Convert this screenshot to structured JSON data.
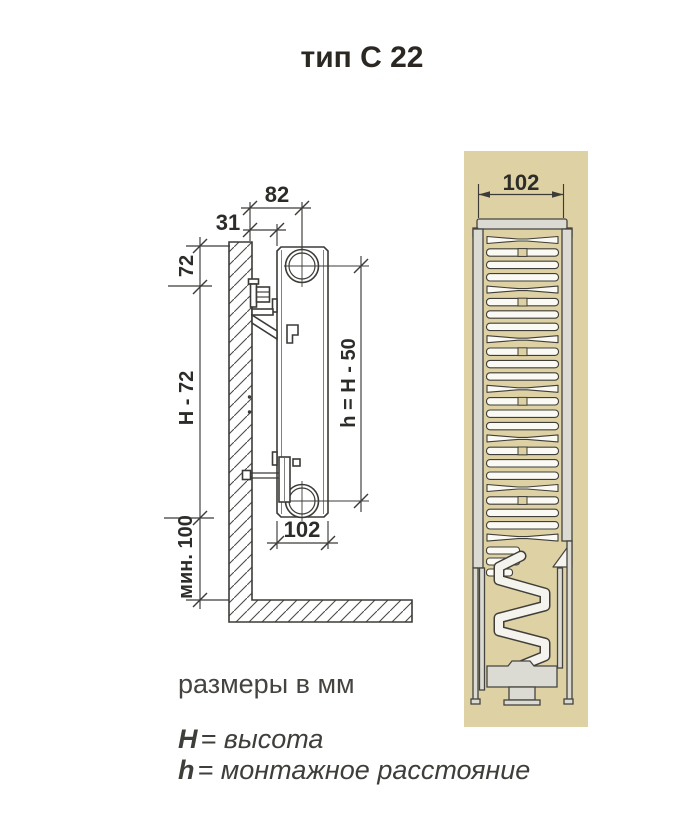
{
  "title": "тип С 22",
  "side_view": {
    "dims": {
      "top_offset": "82",
      "wall_gap": "31",
      "top_margin": "72",
      "height_span": "H - 72",
      "floor_clearance": "мин. 100",
      "mount_distance": "h = H - 50",
      "depth": "102"
    }
  },
  "section_view": {
    "dims": {
      "width": "102"
    }
  },
  "legend": {
    "units_note": "размеры в мм",
    "height_symbol": "H",
    "height_def": "= высота",
    "mount_symbol": "h",
    "mount_def": "= монтажное расстояние"
  },
  "colors": {
    "panel_background": "#ded1a4",
    "line": "#3c3b37",
    "metal_fill": "#dbdad3",
    "fin_fill": "#faf9f4",
    "text": "#2d2c28"
  }
}
